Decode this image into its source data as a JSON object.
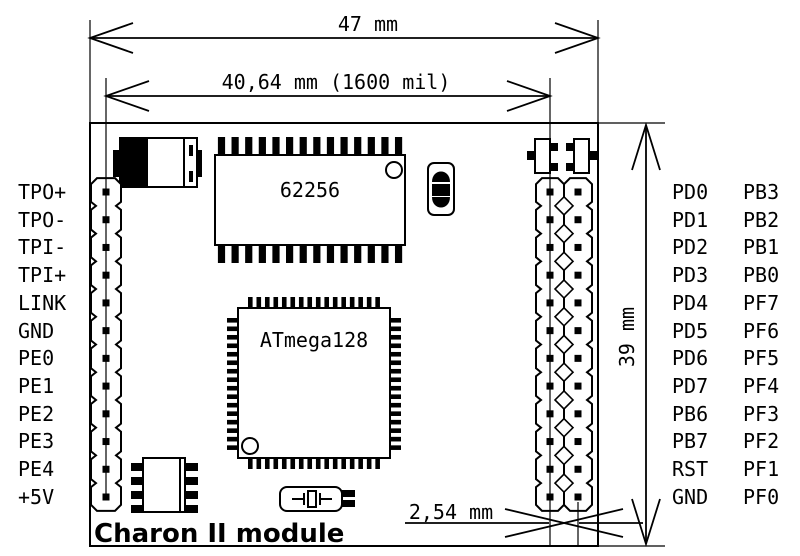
{
  "title": "Charon II module",
  "dimensions": {
    "width": "47 mm",
    "header_span": "40,64 mm (1600 mil)",
    "height": "39 mm",
    "pin_pitch": "2,54 mm"
  },
  "chips": {
    "sram": "62256",
    "mcu": "ATmega128"
  },
  "pins": {
    "left": [
      "TPO+",
      "TPO-",
      "TPI-",
      "TPI+",
      "LINK",
      "GND",
      "PE0",
      "PE1",
      "PE2",
      "PE3",
      "PE4",
      "+5V"
    ],
    "right_inner": [
      "PD0",
      "PD1",
      "PD2",
      "PD3",
      "PD4",
      "PD5",
      "PD6",
      "PD7",
      "PB6",
      "PB7",
      "RST",
      "GND"
    ],
    "right_outer": [
      "PB3",
      "PB2",
      "PB1",
      "PB0",
      "PF7",
      "PF6",
      "PF5",
      "PF4",
      "PF3",
      "PF2",
      "PF1",
      "PF0"
    ]
  },
  "colors": {
    "ink": "#000000",
    "paper": "#ffffff"
  }
}
